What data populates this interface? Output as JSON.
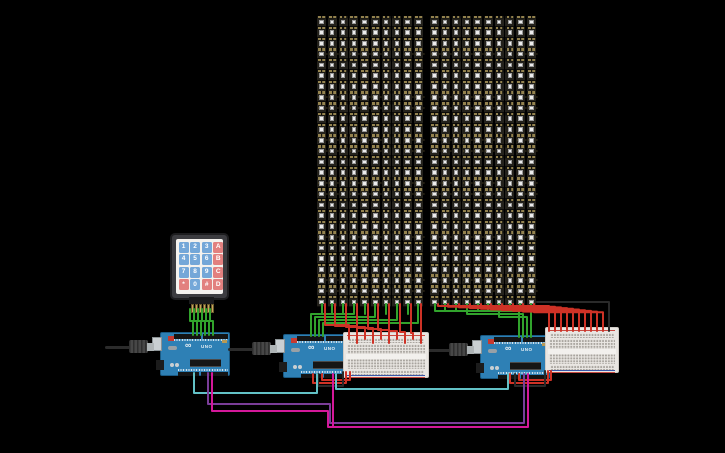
{
  "canvas": {
    "width": 725,
    "height": 453,
    "background": "#000000"
  },
  "palette": {
    "green": "#31A32C",
    "red": "#CE3226",
    "black": "#2A2A2A",
    "teal": "#62C1C6",
    "purple": "#7A3D98",
    "magenta": "#D4189A",
    "board_blue": "#2E80B5",
    "key_blue": "#74A7D8",
    "key_pink": "#E2807F",
    "led_gold": "#93824E",
    "breadboard_bg": "#E9E6E2",
    "rail_red": "#C84A42",
    "rail_blue": "#3A57A8"
  },
  "arduino": {
    "label": "UNO",
    "logo": "∞"
  },
  "keypad": {
    "x": 170,
    "y": 233,
    "keys": [
      [
        "1",
        "2",
        "3",
        "A"
      ],
      [
        "4",
        "5",
        "6",
        "B"
      ],
      [
        "7",
        "8",
        "9",
        "C"
      ],
      [
        "*",
        "0",
        "#",
        "D"
      ]
    ],
    "pins": 6
  },
  "matrices": [
    {
      "name": "led-matrix-1",
      "x": 317,
      "y": 16,
      "cols": 10,
      "rows": 27,
      "pitch": 10.77
    },
    {
      "name": "led-matrix-2",
      "x": 430,
      "y": 16,
      "cols": 10,
      "rows": 27,
      "pitch": 10.77
    }
  ],
  "arduinos": [
    {
      "name": "arduino-uno-1",
      "x": 160,
      "y": 332
    },
    {
      "name": "arduino-uno-2",
      "x": 283,
      "y": 334
    },
    {
      "name": "arduino-uno-3",
      "x": 480,
      "y": 335
    }
  ],
  "usb_cables": [
    {
      "name": "usb-cable-1",
      "x": 105,
      "y": 339
    },
    {
      "name": "usb-cable-2",
      "x": 228,
      "y": 341
    },
    {
      "name": "usb-cable-3",
      "x": 425,
      "y": 342
    }
  ],
  "breadboards": [
    {
      "name": "breadboard-1",
      "x": 343,
      "y": 332,
      "w": 86,
      "h": 46
    },
    {
      "name": "breadboard-2",
      "x": 545,
      "y": 327,
      "w": 74,
      "h": 46
    }
  ],
  "wires": [
    {
      "name": "keypad-wire-1",
      "color": "green",
      "pts": [
        [
          190,
          309
        ],
        [
          190,
          321
        ],
        [
          193,
          321
        ],
        [
          193,
          335
        ]
      ]
    },
    {
      "name": "keypad-wire-2",
      "color": "green",
      "pts": [
        [
          194,
          309
        ],
        [
          194,
          321
        ],
        [
          197,
          321
        ],
        [
          197,
          335
        ]
      ]
    },
    {
      "name": "keypad-wire-3",
      "color": "green",
      "pts": [
        [
          198,
          309
        ],
        [
          198,
          321
        ],
        [
          201,
          321
        ],
        [
          201,
          335
        ]
      ]
    },
    {
      "name": "keypad-wire-4",
      "color": "green",
      "pts": [
        [
          202,
          309
        ],
        [
          202,
          321
        ],
        [
          205,
          321
        ],
        [
          205,
          335
        ]
      ]
    },
    {
      "name": "keypad-wire-5",
      "color": "green",
      "pts": [
        [
          206,
          309
        ],
        [
          206,
          321
        ],
        [
          209,
          321
        ],
        [
          209,
          335
        ]
      ]
    },
    {
      "name": "keypad-wire-6",
      "color": "green",
      "pts": [
        [
          210,
          309
        ],
        [
          210,
          321
        ],
        [
          213,
          321
        ],
        [
          213,
          335
        ]
      ]
    },
    {
      "name": "m1-data-stub-1",
      "color": "green",
      "pts": [
        [
          322,
          304
        ],
        [
          322,
          314
        ]
      ]
    },
    {
      "name": "m1-data-stub-2",
      "color": "green",
      "pts": [
        [
          332,
          304
        ],
        [
          332,
          314
        ]
      ]
    },
    {
      "name": "m1-data-stub-3",
      "color": "green",
      "pts": [
        [
          343,
          304
        ],
        [
          343,
          314
        ]
      ]
    },
    {
      "name": "m1-data-stub-4",
      "color": "green",
      "pts": [
        [
          365,
          304
        ],
        [
          365,
          314
        ]
      ]
    },
    {
      "name": "m1-data-stub-5",
      "color": "green",
      "pts": [
        [
          386,
          304
        ],
        [
          386,
          314
        ]
      ]
    },
    {
      "name": "m1-data-stub-6",
      "color": "green",
      "pts": [
        [
          408,
          304
        ],
        [
          408,
          314
        ]
      ]
    },
    {
      "name": "m1-data-bus-1",
      "color": "green",
      "pts": [
        [
          354,
          304
        ],
        [
          354,
          314
        ],
        [
          311,
          314
        ],
        [
          311,
          336
        ]
      ]
    },
    {
      "name": "m1-data-bus-2",
      "color": "green",
      "pts": [
        [
          375,
          304
        ],
        [
          375,
          317
        ],
        [
          315,
          317
        ],
        [
          315,
          336
        ]
      ]
    },
    {
      "name": "m1-data-bus-3",
      "color": "green",
      "pts": [
        [
          397,
          304
        ],
        [
          397,
          320
        ],
        [
          319,
          320
        ],
        [
          319,
          336
        ]
      ]
    },
    {
      "name": "m1-data-bus-4",
      "color": "green",
      "pts": [
        [
          418,
          304
        ],
        [
          418,
          323
        ],
        [
          323,
          323
        ],
        [
          323,
          336
        ]
      ]
    },
    {
      "name": "m1-power-1",
      "color": "red",
      "pts": [
        [
          325,
          304
        ],
        [
          325,
          325
        ],
        [
          349,
          325
        ],
        [
          349,
          339
        ]
      ]
    },
    {
      "name": "m1-power-2",
      "color": "red",
      "pts": [
        [
          335,
          304
        ],
        [
          335,
          326
        ],
        [
          357,
          326
        ],
        [
          357,
          343
        ]
      ]
    },
    {
      "name": "m1-power-3",
      "color": "red",
      "pts": [
        [
          346,
          304
        ],
        [
          346,
          327
        ],
        [
          365,
          327
        ],
        [
          365,
          339
        ]
      ]
    },
    {
      "name": "m1-power-4",
      "color": "red",
      "pts": [
        [
          357,
          304
        ],
        [
          357,
          328
        ],
        [
          373,
          328
        ],
        [
          373,
          343
        ]
      ]
    },
    {
      "name": "m1-power-5",
      "color": "red",
      "pts": [
        [
          368,
          304
        ],
        [
          368,
          329
        ],
        [
          381,
          329
        ],
        [
          381,
          339
        ]
      ]
    },
    {
      "name": "m1-power-6",
      "color": "red",
      "pts": [
        [
          378,
          304
        ],
        [
          378,
          330
        ],
        [
          389,
          330
        ],
        [
          389,
          343
        ]
      ]
    },
    {
      "name": "m1-power-7",
      "color": "red",
      "pts": [
        [
          389,
          304
        ],
        [
          389,
          331
        ],
        [
          397,
          331
        ],
        [
          397,
          339
        ]
      ]
    },
    {
      "name": "m1-power-8",
      "color": "red",
      "pts": [
        [
          400,
          304
        ],
        [
          400,
          332
        ],
        [
          405,
          332
        ],
        [
          405,
          343
        ]
      ]
    },
    {
      "name": "m1-power-9",
      "color": "red",
      "pts": [
        [
          411,
          304
        ],
        [
          411,
          333
        ],
        [
          413,
          333
        ],
        [
          413,
          339
        ]
      ]
    },
    {
      "name": "m1-power-10",
      "color": "red",
      "pts": [
        [
          421,
          304
        ],
        [
          421,
          343
        ]
      ]
    },
    {
      "name": "m2-data-stub-1",
      "color": "green",
      "pts": [
        [
          445,
          304
        ],
        [
          445,
          311
        ]
      ]
    },
    {
      "name": "m2-data-stub-2",
      "color": "green",
      "pts": [
        [
          456,
          304
        ],
        [
          456,
          311
        ]
      ]
    },
    {
      "name": "m2-data-stub-3",
      "color": "green",
      "pts": [
        [
          478,
          304
        ],
        [
          478,
          311
        ]
      ]
    },
    {
      "name": "m2-data-stub-4",
      "color": "green",
      "pts": [
        [
          488,
          304
        ],
        [
          488,
          311
        ]
      ]
    },
    {
      "name": "m2-data-stub-5",
      "color": "green",
      "pts": [
        [
          510,
          304
        ],
        [
          510,
          311
        ]
      ]
    },
    {
      "name": "m2-data-stub-6",
      "color": "green",
      "pts": [
        [
          520,
          304
        ],
        [
          520,
          311
        ]
      ]
    },
    {
      "name": "m2-data-bus-1",
      "color": "green",
      "pts": [
        [
          435,
          304
        ],
        [
          435,
          311
        ],
        [
          519,
          311
        ],
        [
          519,
          337
        ]
      ]
    },
    {
      "name": "m2-data-bus-2",
      "color": "green",
      "pts": [
        [
          467,
          304
        ],
        [
          467,
          314
        ],
        [
          523,
          314
        ],
        [
          523,
          337
        ]
      ]
    },
    {
      "name": "m2-data-bus-3",
      "color": "green",
      "pts": [
        [
          499,
          304
        ],
        [
          499,
          317
        ],
        [
          527,
          317
        ],
        [
          527,
          337
        ]
      ]
    },
    {
      "name": "m2-data-bus-4",
      "color": "green",
      "pts": [
        [
          531,
          304
        ],
        [
          531,
          320
        ],
        [
          531,
          337
        ]
      ]
    },
    {
      "name": "m2-power-1",
      "color": "red",
      "pts": [
        [
          438,
          304
        ],
        [
          438,
          306
        ],
        [
          549,
          306
        ],
        [
          549,
          331
        ]
      ]
    },
    {
      "name": "m2-power-2",
      "color": "red",
      "pts": [
        [
          448,
          304
        ],
        [
          448,
          306.7
        ],
        [
          555,
          306.7
        ],
        [
          555,
          331
        ]
      ]
    },
    {
      "name": "m2-power-3",
      "color": "red",
      "pts": [
        [
          459,
          304
        ],
        [
          459,
          307.4
        ],
        [
          561,
          307.4
        ],
        [
          561,
          331
        ]
      ]
    },
    {
      "name": "m2-power-4",
      "color": "red",
      "pts": [
        [
          470,
          304
        ],
        [
          470,
          308.1
        ],
        [
          567,
          308.1
        ],
        [
          567,
          331
        ]
      ]
    },
    {
      "name": "m2-power-5",
      "color": "red",
      "pts": [
        [
          481,
          304
        ],
        [
          481,
          308.8
        ],
        [
          573,
          308.8
        ],
        [
          573,
          331
        ]
      ]
    },
    {
      "name": "m2-power-6",
      "color": "red",
      "pts": [
        [
          491,
          304
        ],
        [
          491,
          309.5
        ],
        [
          579,
          309.5
        ],
        [
          579,
          331
        ]
      ]
    },
    {
      "name": "m2-power-7",
      "color": "red",
      "pts": [
        [
          502,
          304
        ],
        [
          502,
          310.2
        ],
        [
          585,
          310.2
        ],
        [
          585,
          331
        ]
      ]
    },
    {
      "name": "m2-power-8",
      "color": "red",
      "pts": [
        [
          513,
          304
        ],
        [
          513,
          310.9
        ],
        [
          591,
          310.9
        ],
        [
          591,
          331
        ]
      ]
    },
    {
      "name": "m2-power-9",
      "color": "red",
      "pts": [
        [
          523,
          304
        ],
        [
          523,
          311.6
        ],
        [
          597,
          311.6
        ],
        [
          597,
          331
        ]
      ]
    },
    {
      "name": "m2-power-10",
      "color": "red",
      "pts": [
        [
          534,
          304
        ],
        [
          534,
          312.3
        ],
        [
          603,
          312.3
        ],
        [
          603,
          331
        ]
      ]
    },
    {
      "name": "bb2-ground-wire",
      "color": "black",
      "pts": [
        [
          537,
          302
        ],
        [
          609,
          302
        ],
        [
          609,
          331
        ]
      ]
    },
    {
      "name": "a2-bb1-5v-1",
      "color": "red",
      "pts": [
        [
          313,
          374
        ],
        [
          313,
          383
        ],
        [
          346,
          383
        ],
        [
          346,
          372
        ]
      ]
    },
    {
      "name": "a2-bb1-5v-2",
      "color": "red",
      "pts": [
        [
          322,
          374
        ],
        [
          322,
          380
        ],
        [
          350,
          380
        ],
        [
          350,
          372
        ]
      ]
    },
    {
      "name": "a2-bb1-gnd",
      "color": "black",
      "pts": [
        [
          318,
          374
        ],
        [
          318,
          386
        ],
        [
          343,
          386
        ],
        [
          343,
          372
        ]
      ]
    },
    {
      "name": "a3-bb2-5v-1",
      "color": "red",
      "pts": [
        [
          510,
          374
        ],
        [
          510,
          383
        ],
        [
          548,
          383
        ],
        [
          548,
          371
        ]
      ]
    },
    {
      "name": "a3-bb2-5v-2",
      "color": "red",
      "pts": [
        [
          519,
          374
        ],
        [
          519,
          380
        ],
        [
          551,
          380
        ],
        [
          551,
          371
        ]
      ]
    },
    {
      "name": "a3-bb2-gnd",
      "color": "black",
      "pts": [
        [
          515,
          374
        ],
        [
          515,
          386
        ],
        [
          545,
          386
        ],
        [
          545,
          371
        ]
      ]
    },
    {
      "name": "serial-teal-1",
      "color": "teal",
      "pts": [
        [
          194,
          373
        ],
        [
          194,
          393
        ],
        [
          317,
          393
        ],
        [
          317,
          374
        ]
      ]
    },
    {
      "name": "serial-teal-2",
      "color": "teal",
      "pts": [
        [
          336,
          374
        ],
        [
          336,
          389
        ],
        [
          508,
          389
        ],
        [
          508,
          374
        ]
      ]
    },
    {
      "name": "serial-purple",
      "color": "purple",
      "pts": [
        [
          208,
          373
        ],
        [
          208,
          404
        ],
        [
          330,
          404
        ],
        [
          330,
          423
        ],
        [
          524,
          423
        ],
        [
          524,
          374
        ]
      ]
    },
    {
      "name": "serial-magenta-1",
      "color": "magenta",
      "pts": [
        [
          212,
          373
        ],
        [
          212,
          411
        ],
        [
          328,
          411
        ],
        [
          328,
          427
        ],
        [
          528,
          427
        ],
        [
          528,
          374
        ]
      ]
    },
    {
      "name": "serial-magenta-2",
      "color": "magenta",
      "pts": [
        [
          333,
          374
        ],
        [
          333,
          427
        ]
      ]
    }
  ]
}
